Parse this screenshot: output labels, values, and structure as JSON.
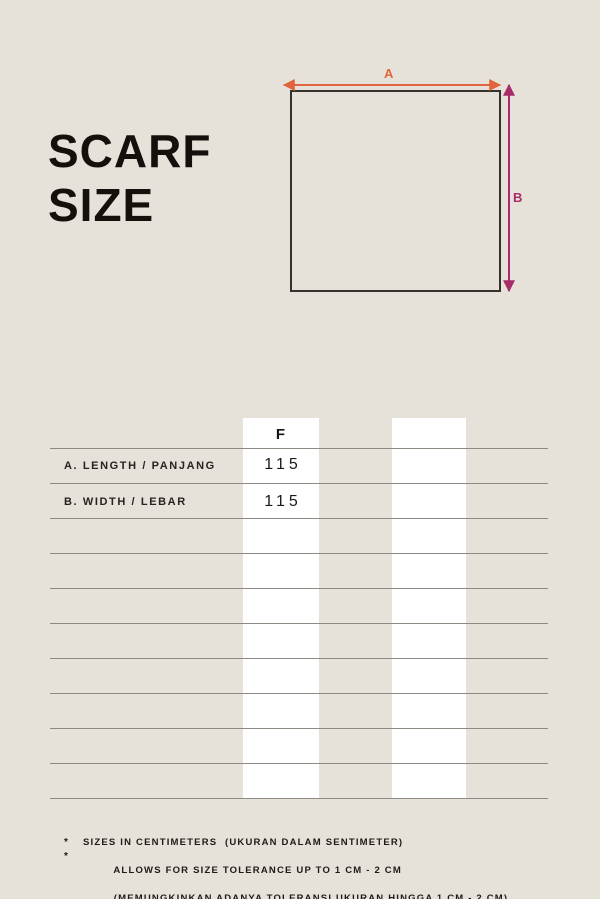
{
  "title": {
    "line1": "SCARF",
    "line2": "SIZE"
  },
  "diagram": {
    "label_a": "A",
    "label_b": "B"
  },
  "table": {
    "column_header": "F",
    "rows": [
      {
        "label": "A.  LENGTH / PANJANG",
        "value": "115"
      },
      {
        "label": "B.  WIDTH / LEBAR",
        "value": "115"
      }
    ],
    "empty_row_count": 8
  },
  "footnotes": {
    "bullet1": "*",
    "bullet2": "*",
    "note1": "SIZES IN CENTIMETERS  (UKURAN DALAM SENTIMETER)",
    "note2_line1": "ALLOWS FOR SIZE TOLERANCE UP TO 1 CM - 2 CM",
    "note2_line2": "(MEMUNGKINKAN ADANYA TOLERANSI UKURAN HINGGA 1 CM - 2 CM)"
  },
  "colors": {
    "background": "#e6e2d9",
    "title_text": "#14110d",
    "grid_line": "#8c8a82",
    "column_band": "#ffffff",
    "square_border": "#35322c",
    "arrow_a": "#e0653e",
    "arrow_b": "#a82b6a"
  }
}
